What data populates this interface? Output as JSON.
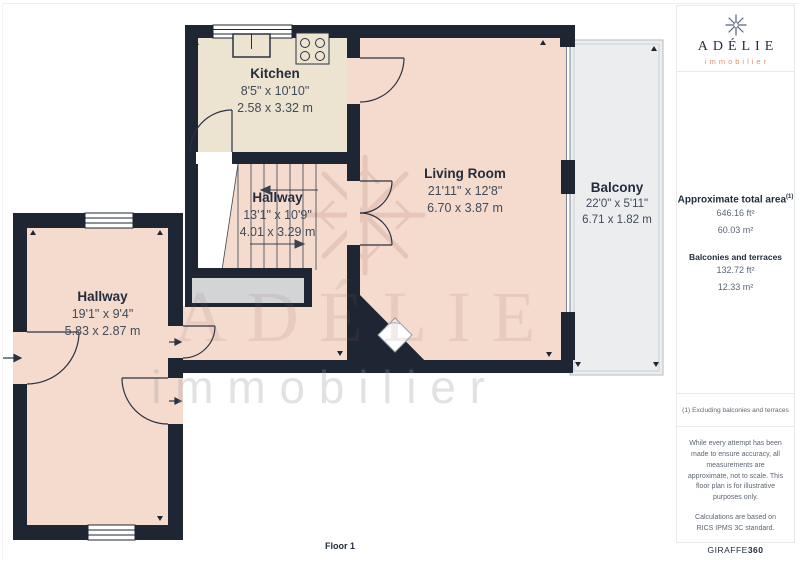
{
  "plan": {
    "rooms": {
      "kitchen": {
        "name": "Kitchen",
        "imperial": "8'5\" x 10'10\"",
        "metric": "2.58 x 3.32 m"
      },
      "living_room": {
        "name": "Living Room",
        "imperial": "21'11\" x 12'8\"",
        "metric": "6.70 x 3.87 m"
      },
      "balcony": {
        "name": "Balcony",
        "imperial": "22'0\" x 5'11\"",
        "metric": "6.71 x 1.82 m"
      },
      "stair_hallway": {
        "name": "Hallway",
        "imperial": "13'1\" x 10'9\"",
        "metric": "4.01 x 3.29 m"
      },
      "entrance_hallway": {
        "name": "Hallway",
        "imperial": "19'1\" x 9'4\"",
        "metric": "5.83 x 2.87 m"
      }
    },
    "floor_label": "Floor 1",
    "watermark": {
      "brand": "ADÉLIE",
      "tagline": "immobilier"
    }
  },
  "sidebar": {
    "logo": {
      "brand": "ADÉLIE",
      "tagline": "immobilier",
      "icon": "snowflake-icon"
    },
    "area_summary": {
      "title": "Approximate total area",
      "footnote_marker": "(1)",
      "total_ft": "646.16 ft²",
      "total_m": "60.03 m²",
      "balconies_title": "Balconies and terraces",
      "balconies_ft": "132.72 ft²",
      "balconies_m": "12.33 m²"
    },
    "footnote": "(1) Excluding balconies and terraces",
    "disclaimers": {
      "p1": "While every attempt has been made to ensure accuracy, all measurements are approximate, not to scale. This floor plan is for illustrative purposes only.",
      "p2": "Calculations are based on RICS IPMS 3C standard.",
      "brand": "GIRAFFE",
      "brand_suffix": "360"
    }
  },
  "colors": {
    "wall": "#1e2533",
    "kitchen_floor": "#ece4d1",
    "room_floor": "#f4dbce",
    "balcony_floor": "#ecedef",
    "stair_landing": "#d3d4d6",
    "accent_salmon": "#e09079",
    "text_dark": "#242d3d"
  }
}
